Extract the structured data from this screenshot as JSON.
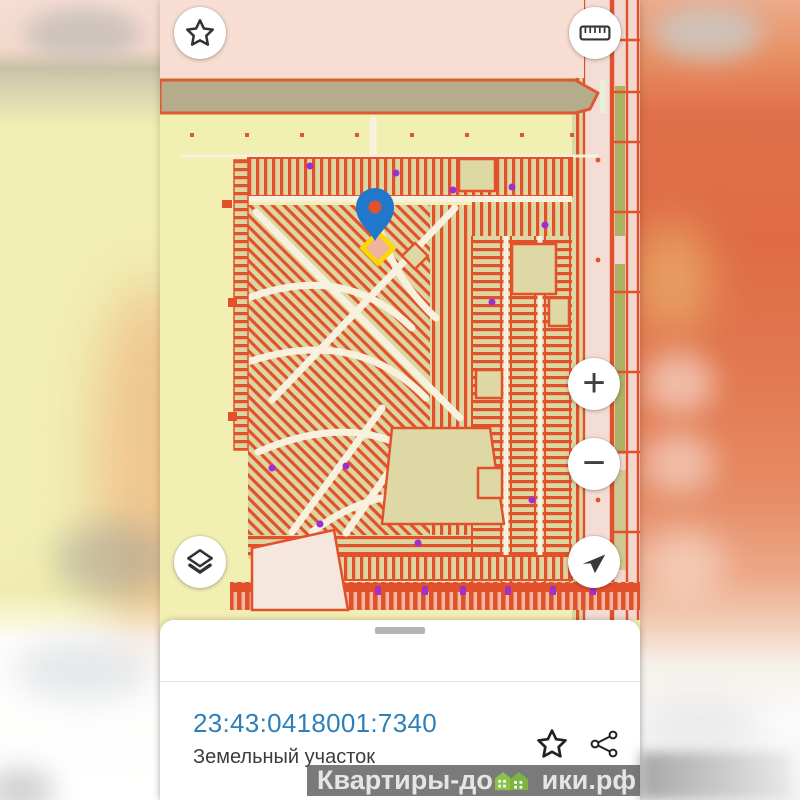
{
  "top_bar": {
    "favorite_icon": "star-icon",
    "measure_icon": "ruler-icon"
  },
  "map": {
    "pin_icon": "location-pin-icon",
    "pin_color": "#2077cb",
    "selected_parcel_highlight_color": "#ffd800",
    "parcel_line_color": "#e2512c",
    "background_color": "#f2efb3"
  },
  "controls": {
    "zoom_in_label": "+",
    "zoom_out_label": "−",
    "layers_icon": "layers-icon",
    "compass_icon": "navigation-arrow-icon"
  },
  "bottom_sheet": {
    "cadastral_number": "23:43:0418001:7340",
    "object_type": "Земельный участок",
    "favorite_icon": "star-outline-icon",
    "share_icon": "share-icon"
  },
  "watermark": {
    "text_before": "Квартиры-до",
    "text_after": "ики.рф",
    "house_icon": "house-icon",
    "house_color": "#8bc34a"
  }
}
